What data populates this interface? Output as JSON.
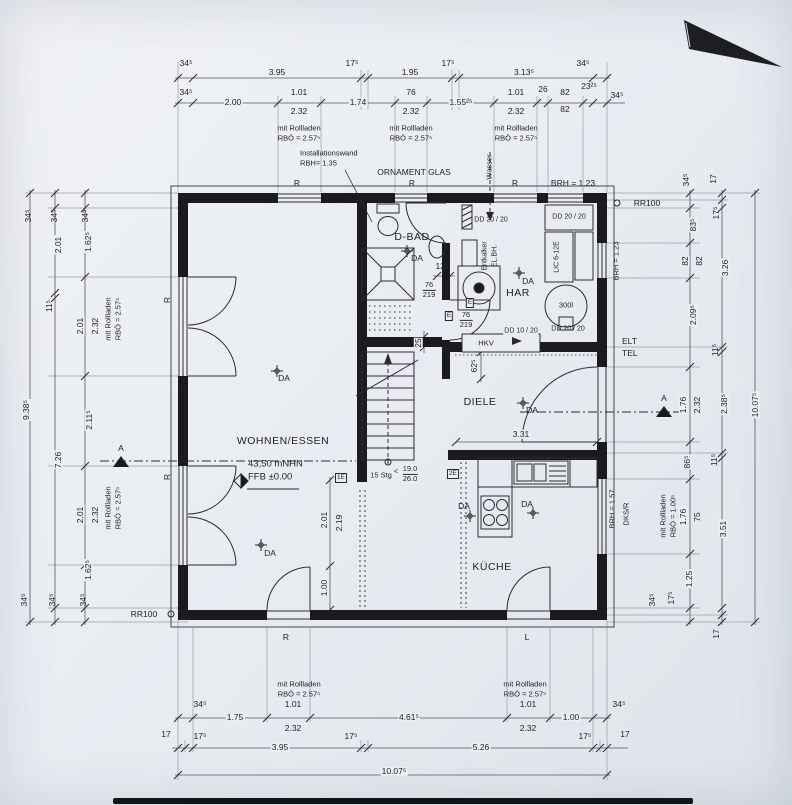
{
  "rooms": {
    "living": "WOHNEN/ESSEN",
    "kitchen": "KÜCHE",
    "hall": "DIELE",
    "bath": "D-BAD",
    "utility": "HAR"
  },
  "levels": {
    "datum": "43,50 mNHN",
    "ffb": "FFB ±0.00"
  },
  "stairs": {
    "count": "15 Stg",
    "lt": "<",
    "rise": "19.0",
    "run": "26.0"
  },
  "notes": {
    "installationswand": "Installationswand",
    "installationswand_h": "RBH= 1.35",
    "ornament_glas": "ORNAMENT GLAS",
    "wasser": "Wasser",
    "brh_123": "BRH = 1.23",
    "brh_157": "BRH = 1.57",
    "elt": "ELT",
    "tel": "TEL",
    "dks_r": "DKS/R",
    "rr100": "RR100",
    "mit_rollladen": "mit Rollladen",
    "rbo_257": "RBÖ = 2.57⁵",
    "rbo_100": "RBÖ = 1.00⁵",
    "section": "A"
  },
  "markers": {
    "r": "R",
    "l": "L",
    "da": "DA",
    "e": "E",
    "e1": "1E",
    "e2": "2E"
  },
  "equipment": {
    "entkalker": "Entkalker",
    "el_bh": "EL.BH.",
    "tank": "300l",
    "lic": "LIC 6-12E",
    "hkv": "HKV",
    "dd_2020": "DD 20 / 20",
    "dd_1020": "DD 10 / 20"
  },
  "door_tags": {
    "w": "76",
    "h": "219"
  },
  "dims": {
    "top1": [
      "34⁵",
      "3.95",
      "17⁵",
      "1.95",
      "17⁵",
      "3.13⁵",
      "34⁵"
    ],
    "top2": [
      "34⁵",
      "2.00",
      "1.01",
      "1.74",
      "76",
      "1.55²⁵",
      "1.01",
      "26",
      "82",
      "23²⁵",
      "34⁵"
    ],
    "top2b": [
      "2.32",
      "2.32",
      "2.32",
      "82"
    ],
    "left1": [
      "34⁵",
      "9.38⁵",
      "34⁵"
    ],
    "left2": [
      "34⁵",
      "2.01",
      "11⁵",
      "7.26",
      "34⁵"
    ],
    "left3": [
      "34⁵",
      "1.62⁵",
      "2.01",
      "2.32",
      "2.11⁵",
      "2.01",
      "2.32",
      "1.62⁵",
      "34⁵"
    ],
    "right1": [
      "34⁵",
      "83⁵",
      "82",
      "82",
      "2.09⁵",
      "1.76",
      "2.32",
      "86⁵",
      "1.76",
      "75",
      "1.25",
      "34⁵"
    ],
    "right2": [
      "17",
      "17⁵",
      "3.26",
      "11⁵",
      "2.38⁵",
      "11⁵",
      "3.51",
      "17⁵",
      "17"
    ],
    "right3": [
      "10.07⁵"
    ],
    "bottom1": [
      "34⁵",
      "1.75",
      "1.01",
      "2.32",
      "4.61⁵",
      "1.01",
      "2.32",
      "1.00",
      "34⁵"
    ],
    "bottom2": [
      "17",
      "17⁵",
      "3.95",
      "17⁵",
      "5.26",
      "17⁵",
      "17"
    ],
    "bottom3": [
      "10.07⁵"
    ],
    "interior": {
      "diele_w": "3.31",
      "stub_h": "62⁵",
      "wall_t": "25",
      "basin": "12⁵",
      "open_a": "2.01",
      "open_b": "2.19",
      "open_c": "1.00"
    }
  }
}
